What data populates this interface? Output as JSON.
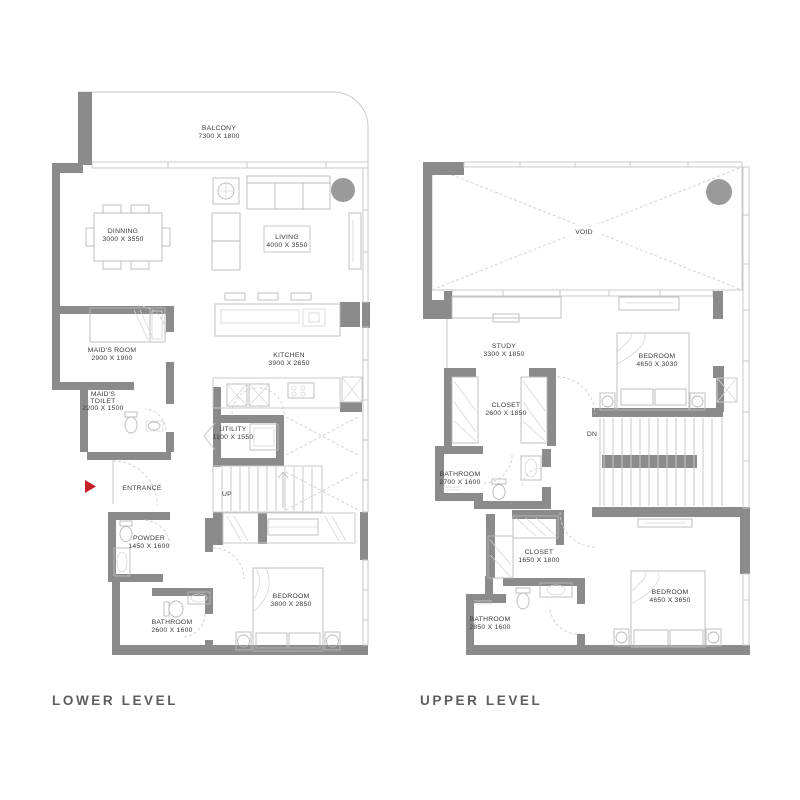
{
  "page": {
    "background": "#ffffff"
  },
  "colors": {
    "wall": "#8b8b8b",
    "thin_line": "#c9c9c9",
    "fixture_line": "#b9b9b9",
    "dashed_line": "#cfcfcf",
    "label_text": "#3a3a3a",
    "title_text": "#5d5d5d",
    "column": "#9a9a9a",
    "entrance_arrow": "#c42127"
  },
  "lower": {
    "title": "LOWER LEVEL",
    "rooms": {
      "balcony": {
        "name": "BALCONY",
        "dims": "7300 X 1800"
      },
      "dinning": {
        "name": "DINNING",
        "dims": "3000 X 3550"
      },
      "living": {
        "name": "LIVING",
        "dims": "4000 X 3550"
      },
      "maids_room": {
        "name": "MAID'S ROOM",
        "dims": "2900 X 1900"
      },
      "maids_toilet": {
        "name1": "MAID'S",
        "name2": "TOILET",
        "dims": "2200 X 1500"
      },
      "kitchen": {
        "name": "KITCHEN",
        "dims": "3900 X 2650"
      },
      "utility": {
        "name": "UTILITY",
        "dims": "1100 X 1550"
      },
      "powder": {
        "name": "POWDER",
        "dims": "1450 X 1600"
      },
      "bathroom": {
        "name": "BATHROOM",
        "dims": "2600 X 1600"
      },
      "bedroom": {
        "name": "BEDROOM",
        "dims": "3800 X 2850"
      }
    },
    "annotations": {
      "entrance": "ENTRANCE",
      "up": "UP"
    }
  },
  "upper": {
    "title": "UPPER LEVEL",
    "rooms": {
      "void": {
        "name": "VOID"
      },
      "study": {
        "name": "STUDY",
        "dims": "3300 X 1850"
      },
      "bedroom1": {
        "name": "BEDROOM",
        "dims": "4650 X 3030"
      },
      "closet1": {
        "name": "CLOSET",
        "dims": "2600 X 1850"
      },
      "bathroom1": {
        "name": "BATHROOM",
        "dims": "2700 X 1600"
      },
      "closet2": {
        "name": "CLOSET",
        "dims": "1650 X 1800"
      },
      "bathroom2": {
        "name": "BATHROOM",
        "dims": "2850 X 1600"
      },
      "bedroom2": {
        "name": "BEDROOM",
        "dims": "4650 X 3650"
      }
    },
    "annotations": {
      "dn": "DN"
    }
  }
}
